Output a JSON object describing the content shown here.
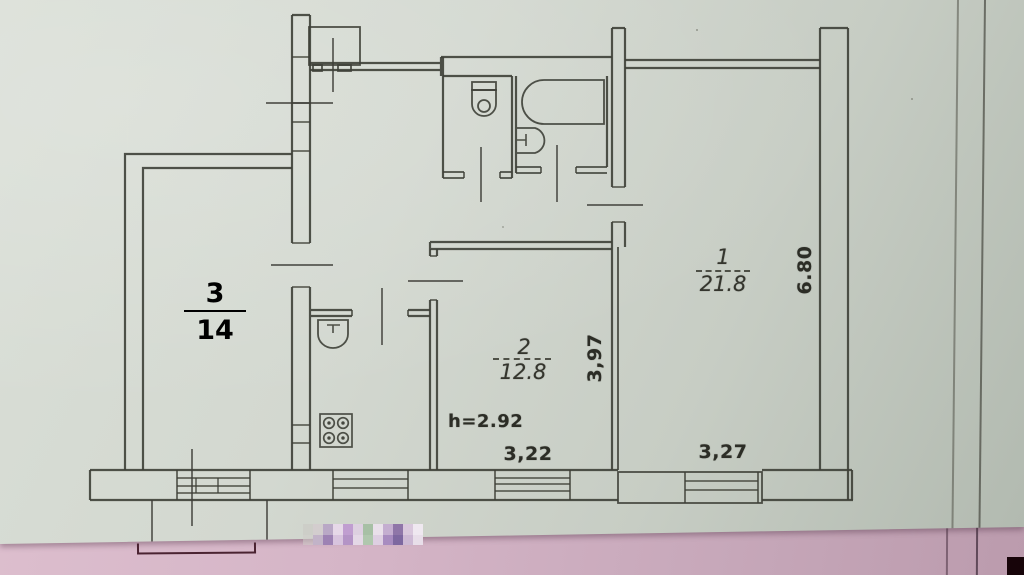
{
  "photo": {
    "subject": "scanned apartment floor plan sheet lying on a pink surface"
  },
  "rooms": [
    {
      "number": "1",
      "area": "21.8"
    },
    {
      "number": "2",
      "area": "12.8"
    },
    {
      "number": "3",
      "area": "14"
    }
  ],
  "dims": {
    "right": "6.80",
    "middle": "3,97",
    "height": "h=2.92",
    "room2_width": "3,22",
    "room1_width": "3,27"
  },
  "fixtures": [
    "vent-shaft",
    "toilet",
    "bathtub",
    "washbasin",
    "kitchen-sink",
    "stove-4-burner"
  ],
  "colors": {
    "paper": "#d2d7cf",
    "ink": "#3f4039",
    "table_pink": "#d2b2c4",
    "room3_label_ink": "#000000"
  }
}
